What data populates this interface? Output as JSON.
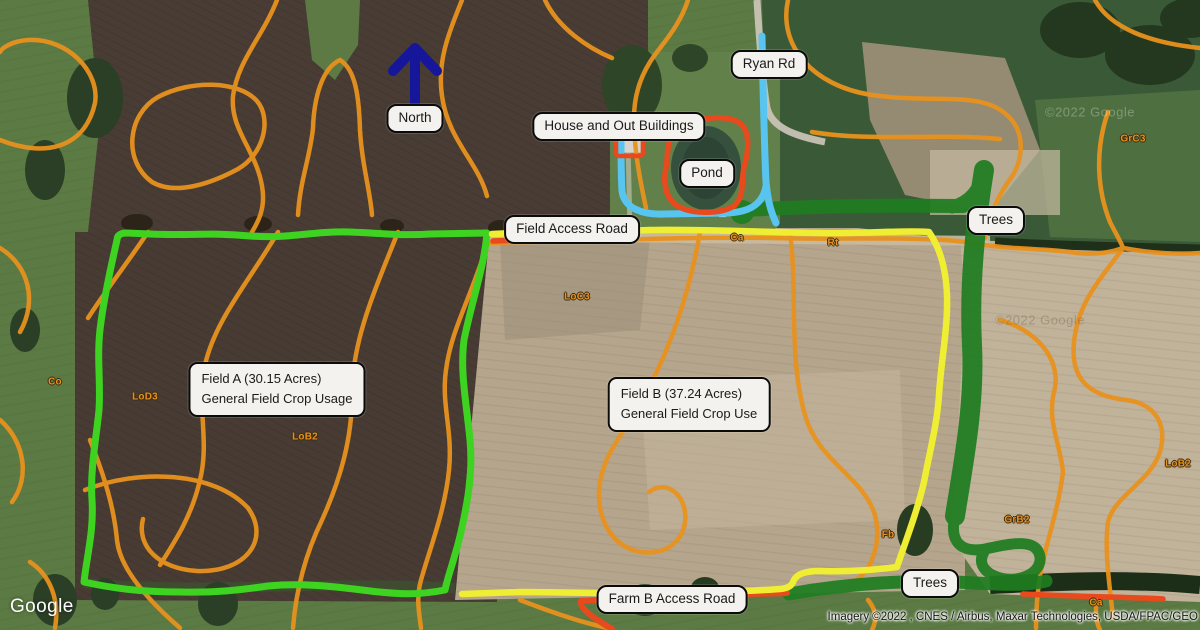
{
  "callouts": {
    "north": "North",
    "ryan_rd": "Ryan Rd",
    "house": "House and Out Buildings",
    "pond": "Pond",
    "field_access_road": "Field Access Road",
    "trees_ne": "Trees",
    "trees_se": "Trees",
    "farm_b_access_road": "Farm B Access Road",
    "field_a_line1": "Field A (30.15 Acres)",
    "field_a_line2": "General Field Crop Usage",
    "field_b_line1": "Field B (37.24 Acres)",
    "field_b_line2": "General Field Crop Use"
  },
  "soil_labels": [
    {
      "text": "Co"
    },
    {
      "text": "LoD3"
    },
    {
      "text": "LoB2"
    },
    {
      "text": "LoC3"
    },
    {
      "text": "Ca"
    },
    {
      "text": "Rt"
    },
    {
      "text": "GrC3"
    },
    {
      "text": "Fb"
    },
    {
      "text": "GrB2"
    },
    {
      "text": "LoB2"
    },
    {
      "text": "Ca"
    }
  ],
  "branding": {
    "logo_text": "Google",
    "attribution": "Imagery ©2022 , CNES / Airbus, Maxar Technologies, USDA/FPAC/GEO",
    "watermark": "©2022 Google"
  },
  "colors": {
    "field_a_boundary": "#3fd321",
    "field_b_boundary": "#f0ee33",
    "road_marking": "#e8491d",
    "ryan_rd_marking": "#58c4f0",
    "trees_marking": "#1f7d20",
    "contours": "#e8921d",
    "north_arrow": "#16169b"
  }
}
